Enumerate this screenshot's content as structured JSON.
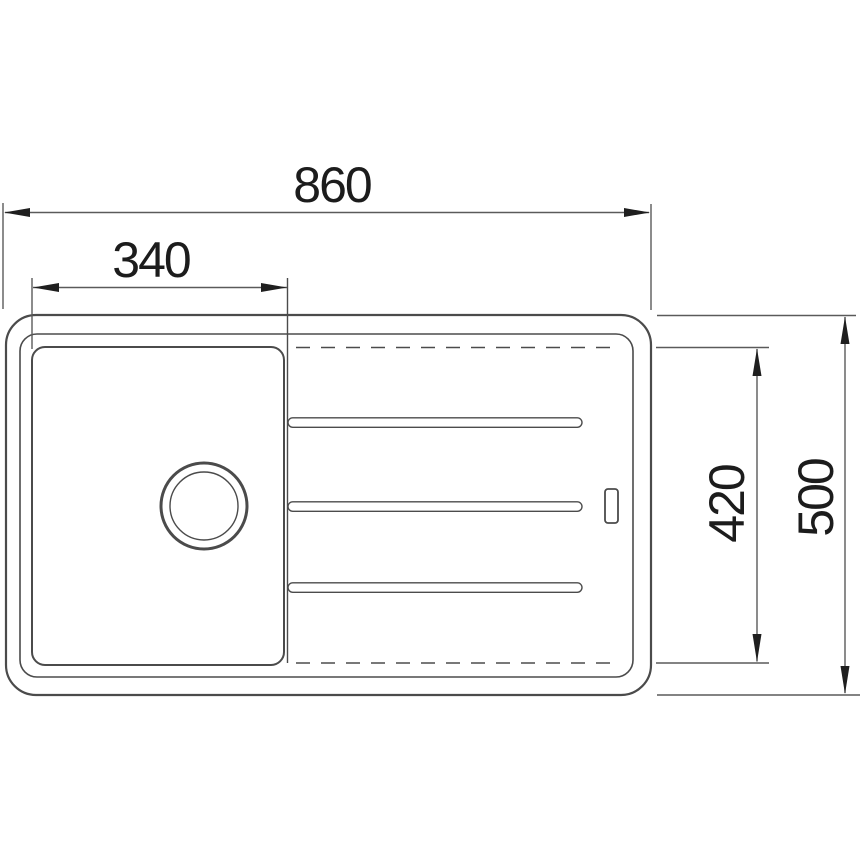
{
  "drawing": {
    "type": "technical-dimension-drawing",
    "subject": "kitchen sink with single bowl and drainboard, top view",
    "dimensions": {
      "overall_width": "860",
      "bowl_width": "340",
      "inner_depth": "420",
      "overall_depth": "500"
    },
    "features": {
      "drain": "drain-hole-circle",
      "overflow": "overflow-slot",
      "grooves": "three-drainboard-grooves",
      "hidden_edge": "dashed-drainer-boundary"
    }
  },
  "colors": {
    "background": "#ffffff",
    "line": "#4b4b4b",
    "dim-line": "#5a5a5a",
    "arrow": "#1f1f1f",
    "text": "#1c1c1c"
  }
}
